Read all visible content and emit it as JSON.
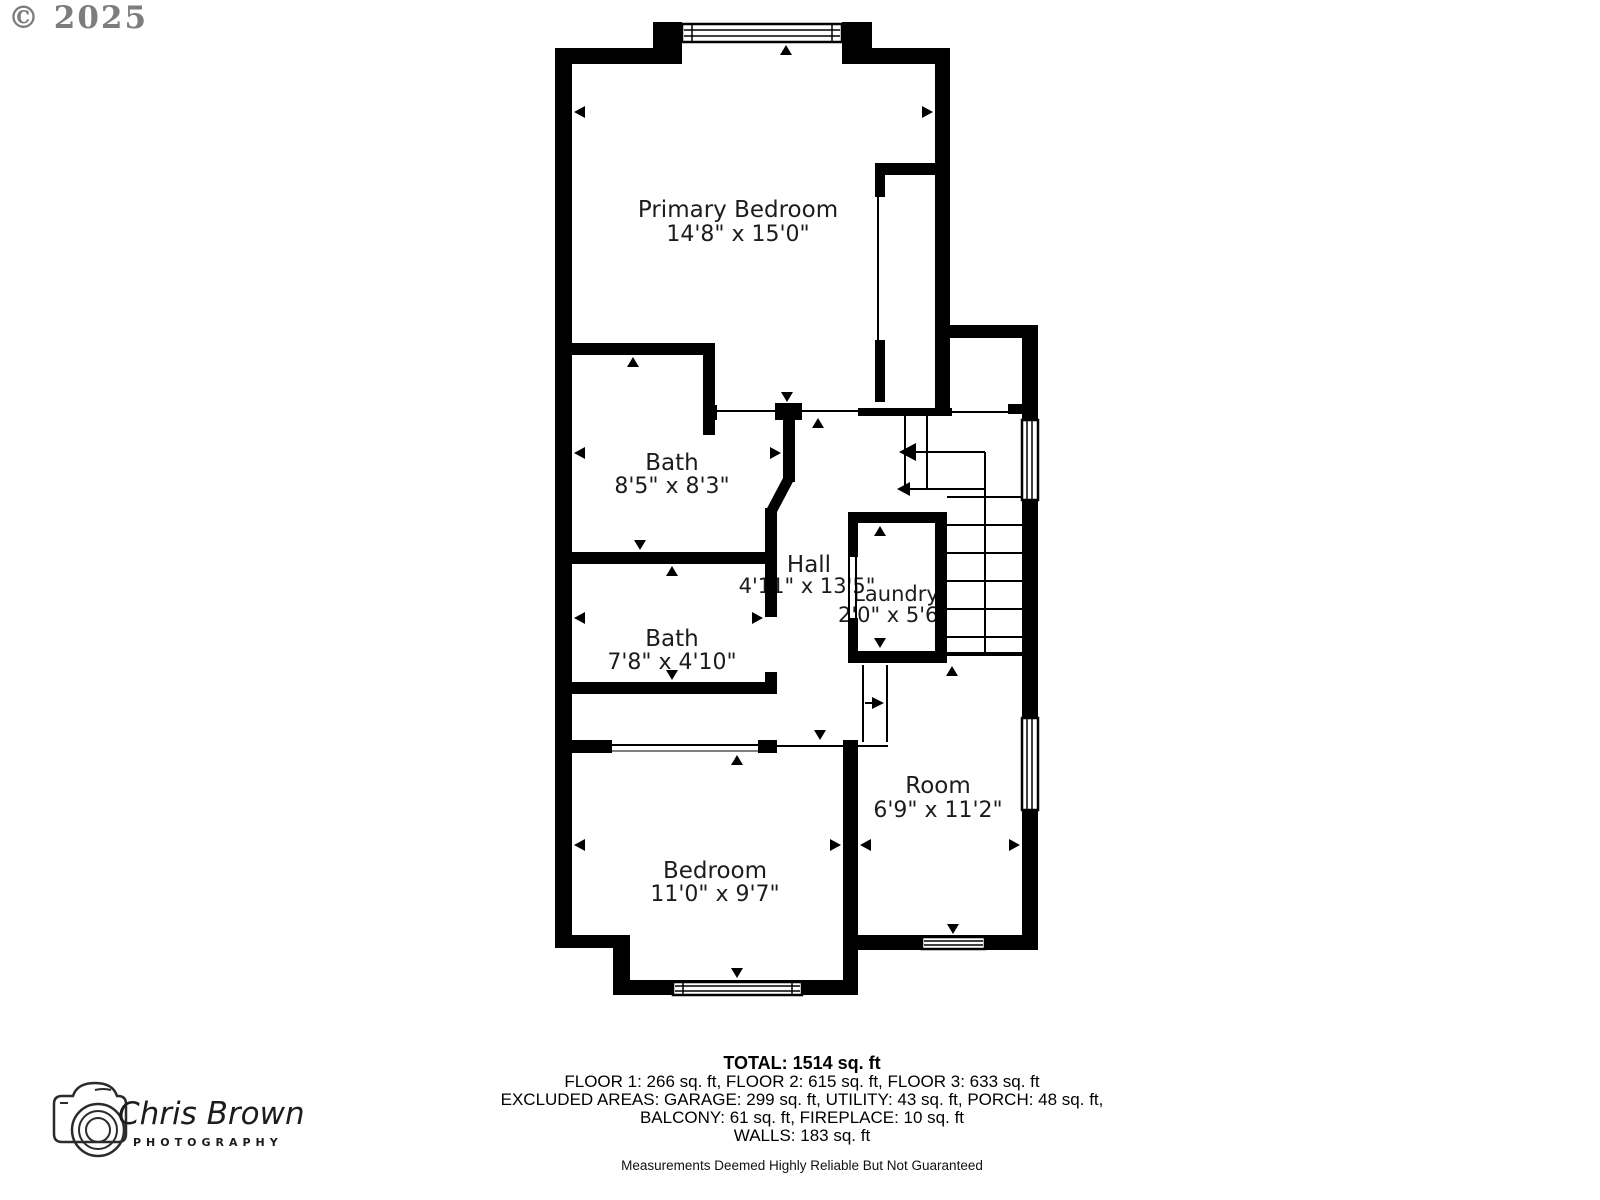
{
  "copyright": "© 2025",
  "plan": {
    "primary_bedroom": {
      "name": "Primary Bedroom",
      "dims": "14'8\" x 15'0\""
    },
    "bath1": {
      "name": "Bath",
      "dims": "8'5\" x 8'3\""
    },
    "hall": {
      "name": "Hall",
      "dims": "4'11\" x 13'5\""
    },
    "laundry": {
      "name": "Laundry",
      "dims": "2'0\" x 5'6\""
    },
    "bath2": {
      "name": "Bath",
      "dims": "7'8\" x 4'10\""
    },
    "bedroom": {
      "name": "Bedroom",
      "dims": "11'0\" x 9'7\""
    },
    "room": {
      "name": "Room",
      "dims": "6'9\" x 11'2\""
    }
  },
  "summary": {
    "total": "TOTAL: 1514 sq. ft",
    "floors": "FLOOR 1: 266 sq. ft, FLOOR 2: 615 sq. ft, FLOOR 3: 633 sq. ft",
    "excluded_line1": "EXCLUDED AREAS: GARAGE: 299 sq. ft, UTILITY: 43 sq. ft, PORCH: 48 sq. ft,",
    "excluded_line2": "BALCONY: 61 sq. ft, FIREPLACE: 10 sq. ft",
    "walls": "WALLS: 183 sq. ft",
    "disclaimer": "Measurements Deemed Highly Reliable But Not Guaranteed"
  },
  "logo": {
    "name": "Chris Brown",
    "subtitle": "PHOTOGRAPHY"
  },
  "colors": {
    "wall": "#000000",
    "text": "#1c1c1c",
    "copyright": "#7d7d7d"
  }
}
